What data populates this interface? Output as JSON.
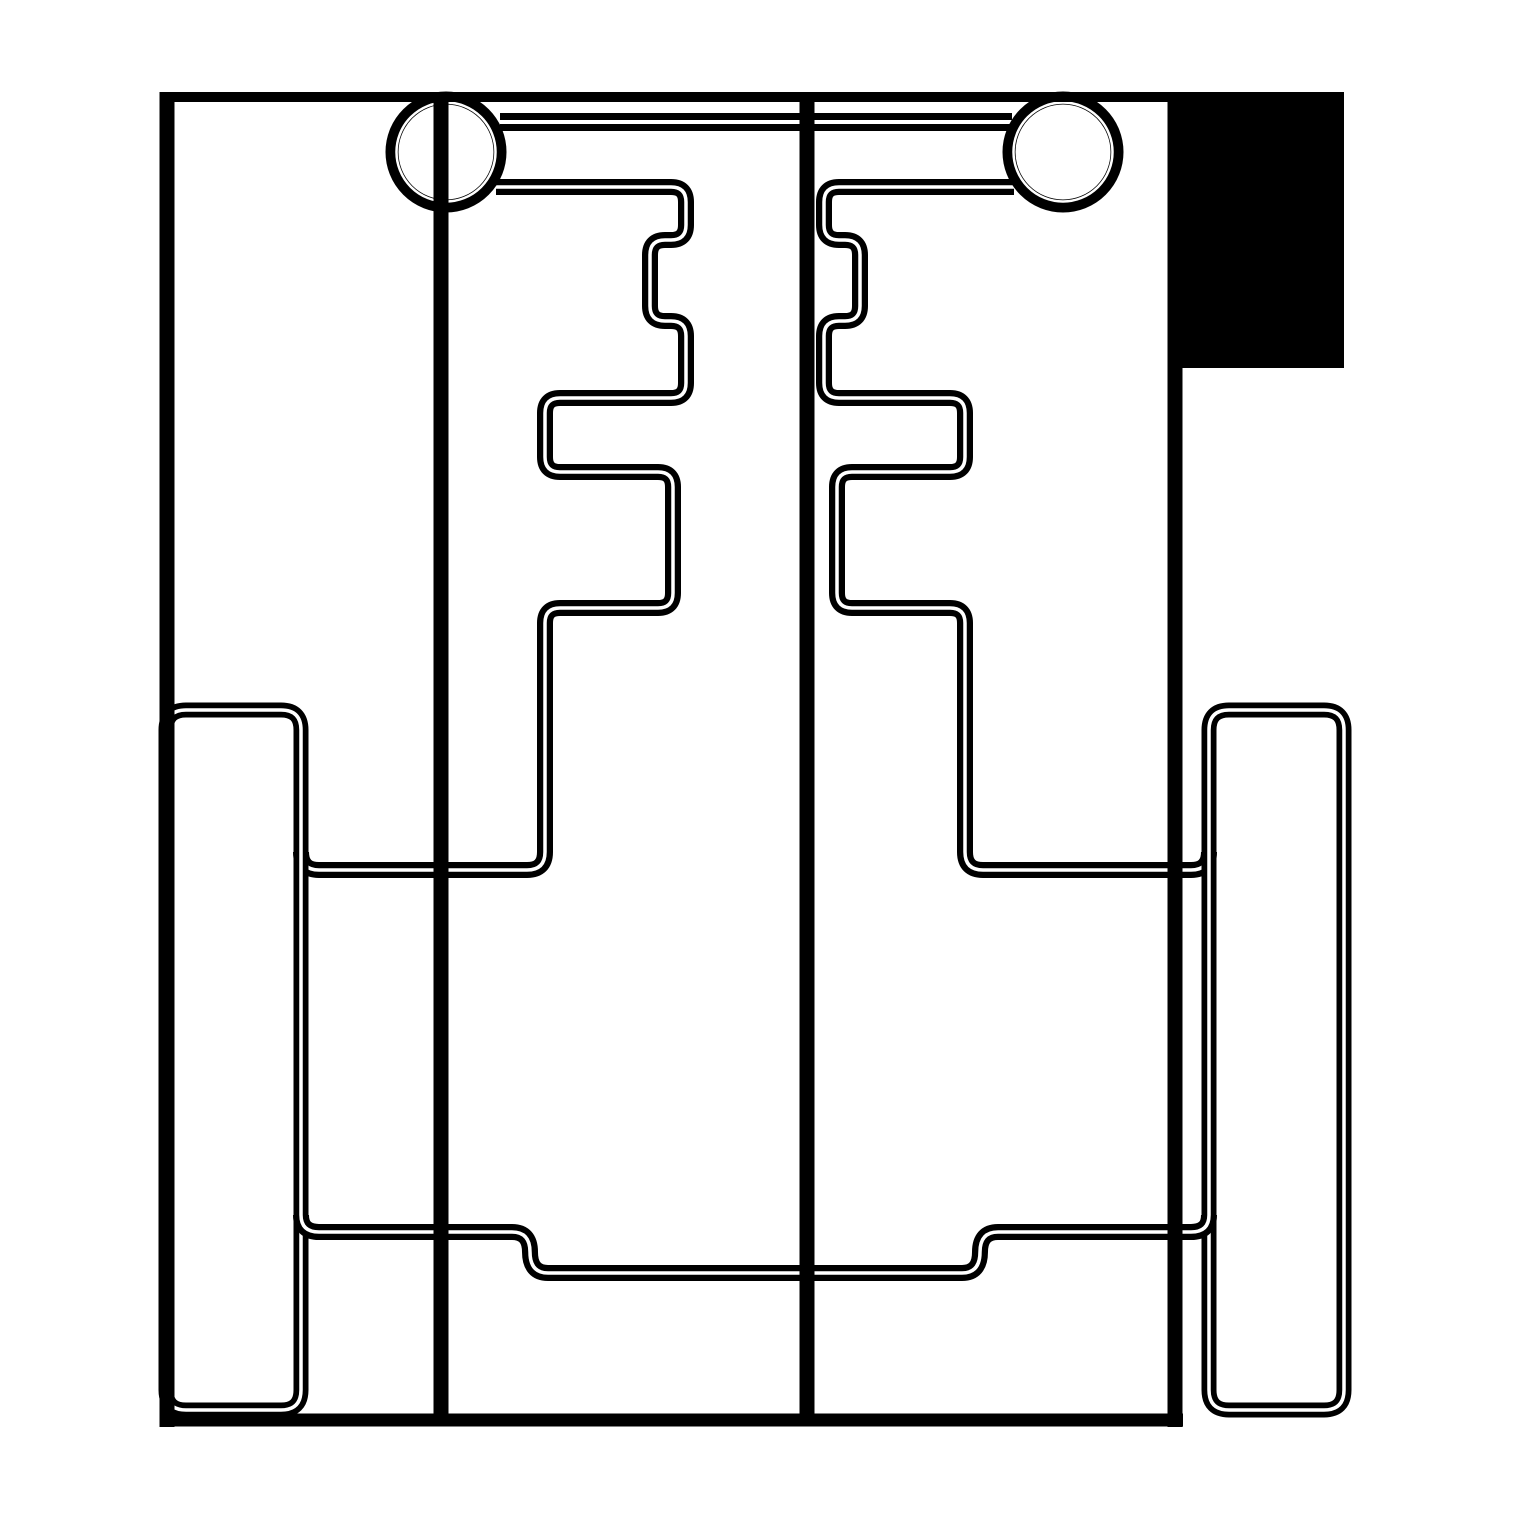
{
  "title": "Mechanical line drawing - chassis plan view with axle hubs, gate contours and wheels",
  "canvas": {
    "width": 1519,
    "height": 1519,
    "background_color": "#ffffff",
    "line_color": "#000000",
    "gap_color": "#ffffff"
  },
  "shapes": {
    "corner_block": {
      "d": "M1168 92 H1344 V368 H1168 Z"
    },
    "chassis_top": {
      "d": "M160 97 H1344"
    },
    "chassis_left": {
      "d": "M167 92 V1427"
    },
    "chassis_right": {
      "d": "M1175 92 V1427"
    },
    "chassis_bottom": {
      "d": "M160 1420 H1183"
    },
    "axle_bar": {
      "d": "M500 122 H1012"
    },
    "hub_left": {
      "d": "M392 152 a54 54 0 1 0 108 0 a54 54 0 1 0 -108 0"
    },
    "hub_left_inner": {
      "d": "M396.5 152 a49.5 49.5 0 1 0 99 0 a49.5 49.5 0 1 0 -99 0"
    },
    "hub_right": {
      "d": "M1009 152 a54 54 0 1 0 108 0 a54 54 0 1 0 -108 0"
    },
    "hub_right_inner": {
      "d": "M1013.5 152 a49.5 49.5 0 1 0 99 0 a49.5 49.5 0 1 0 -99 0"
    },
    "gate_left": {
      "d": "M496 187 L671 187 Q686 187 686 202 L686 225 Q686 240 671 240 L665 240 Q650 240 650 255 L650 306 Q650 321 665 321 L671 321 Q686 321 686 336 L686 383 Q686 398 671 398 L560 398 Q545 398 545 413 L545 457 Q545 472 560 472 L658 472 Q673 472 673 487 L673 593 Q673 608 658 608 L560 608 Q545 608 545 623 L545 852 Q545 870 527 870 L319 870 Q301 870 301 852"
    },
    "gate_right": {
      "d": "M1014 187 L839 187 Q824 187 824 202 L824 225 Q824 240 839 240 L845 240 Q860 240 860 255 L860 306 Q860 321 845 321 L839 321 Q824 321 824 336 L824 383 Q824 398 839 398 L950 398 Q965 398 965 413 L965 457 Q965 472 950 472 L852 472 Q837 472 837 487 L837 593 Q837 608 852 608 L950 608 Q965 608 965 623 L965 852 Q965 870 983 870 L1191 870 Q1209 870 1209 852"
    },
    "wheel_left": {
      "d": "M186 710 H281 Q301 710 301 730 V1390 Q301 1410 281 1410 H186 Q166 1410 166 1390 V730 Q166 710 186 710 Z"
    },
    "wheel_right": {
      "d": "M1229 710 H1324 Q1344 710 1344 730 V1390 Q1344 1410 1324 1410 H1229 Q1209 1410 1209 1390 V730 Q1209 710 1229 710 Z"
    },
    "cross_member": {
      "d": "M301 1215 Q301 1232 319 1232 L512 1232 Q530 1232 530 1252 Q530 1273 548 1273 L962 1273 Q980 1273 980 1252 Q980 1232 998 1232 L1191 1232 Q1209 1232 1209 1215"
    },
    "spine_left": {
      "d": "M441 97 V1420"
    },
    "spine_center": {
      "d": "M807 97 V1420"
    }
  }
}
